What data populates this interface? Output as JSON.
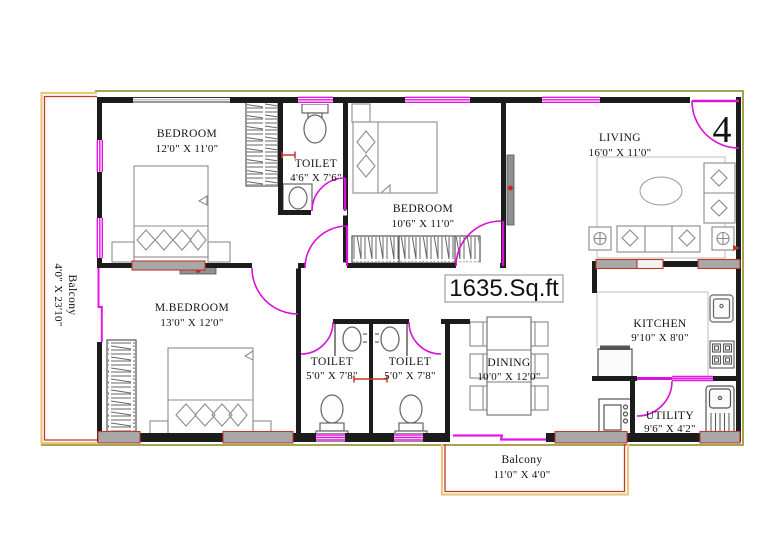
{
  "plan": {
    "total_area": "1635.Sq.ft",
    "unit_number": "4",
    "colors": {
      "wall": "#1c1c1c",
      "window_door_magenta": "#e316e3",
      "balcony_inner_red": "#c0392b",
      "balcony_outer_yellow": "#e8c87a",
      "site_boundary_olive": "#9a9a3a",
      "furniture_grey": "#8c8c8c",
      "window_fill_grey": "#a8a8a8"
    },
    "rooms": {
      "bedroom1": {
        "name": "BEDROOM",
        "dims": "12'0\" X 11'0\""
      },
      "toilet_top": {
        "name": "TOILET",
        "dims": "4'6\" X 7'6\""
      },
      "bedroom2": {
        "name": "BEDROOM",
        "dims": "10'6\" X 11'0\""
      },
      "living": {
        "name": "LIVING",
        "dims": "16'0\" X 11'0\""
      },
      "master": {
        "name": "M.BEDROOM",
        "dims": "13'0\" X 12'0\""
      },
      "toilet1": {
        "name": "TOILET",
        "dims": "5'0\" X 7'8\""
      },
      "toilet2": {
        "name": "TOILET",
        "dims": "5'0\" X 7'8\""
      },
      "dining": {
        "name": "DINING",
        "dims": "10'0\" X 12'0\""
      },
      "kitchen": {
        "name": "KITCHEN",
        "dims": "9'10\" X 8'0\""
      },
      "utility": {
        "name": "UTILITY",
        "dims": "9'6\" X 4'2\""
      },
      "balcony_left": {
        "name": "Balcony",
        "dims": "4'0\" X 23'10\""
      },
      "balcony_bottom": {
        "name": "Balcony",
        "dims": "11'0\" X 4'0\""
      }
    }
  }
}
